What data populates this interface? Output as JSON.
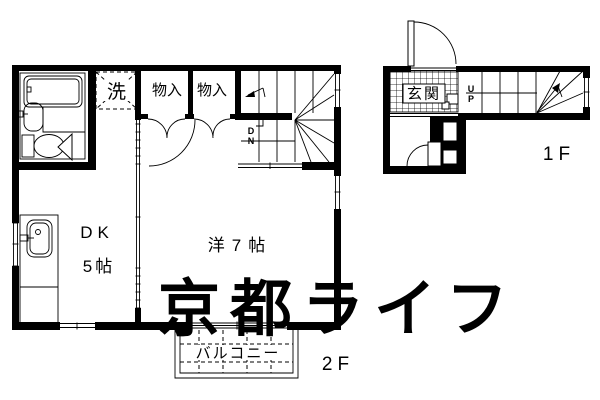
{
  "watermark": {
    "text": "京都ライフ",
    "color": "#e4e4e4"
  },
  "colors": {
    "line": "#000000",
    "background": "#ffffff"
  },
  "floor_2f": {
    "floor_label": "2F",
    "rooms": {
      "laundry": {
        "label": "洗"
      },
      "closet1": {
        "label": "物入"
      },
      "closet2": {
        "label": "物入"
      },
      "dk": {
        "name": "DK",
        "size": "5帖"
      },
      "western_room": {
        "label": "洋7帖"
      },
      "balcony": {
        "label": "バルコニー"
      }
    },
    "stairs": {
      "down_letter1": "D",
      "down_letter2": "N"
    }
  },
  "floor_1f": {
    "floor_label": "1F",
    "rooms": {
      "entrance": {
        "label": "玄関"
      }
    },
    "stairs": {
      "up_letter1": "U",
      "up_letter2": "P"
    }
  }
}
